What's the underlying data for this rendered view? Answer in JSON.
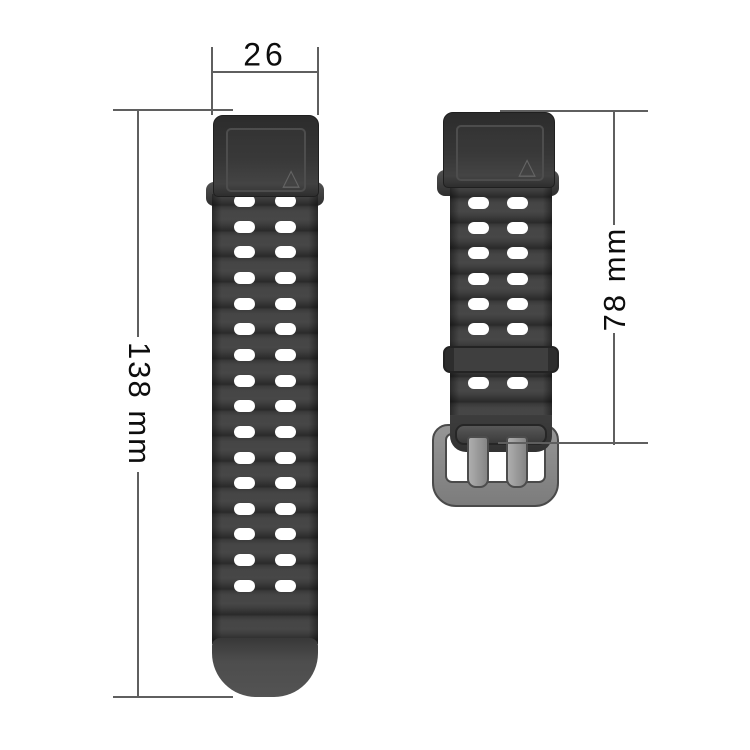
{
  "diagram": {
    "type": "product-dimension-diagram",
    "subject": "silicone watch band set (long strap and short buckle strap)",
    "background": "#ffffff",
    "annotations": {
      "width": {
        "label": "26",
        "unit": "mm (implied)",
        "applies_to": "strap lug width"
      },
      "long_strap_length": {
        "label": "138 mm",
        "orientation": "rotated 90deg clockwise, reads top-to-bottom"
      },
      "short_strap_length": {
        "label": "78 mm",
        "orientation": "rotated 90deg counter-clockwise, reads bottom-to-top"
      }
    },
    "long_strap": {
      "hole_rows": 16,
      "holes_per_row": 2,
      "features": [
        "lug attachment block with triangle mark",
        "ribbed texture",
        "rounded lighter tip"
      ],
      "body_color": "#3a3a3a",
      "tip_color": "#4f4f4f"
    },
    "short_strap": {
      "hole_rows_above_keeper": 6,
      "hole_rows_below_keeper": 1,
      "holes_per_row": 2,
      "features": [
        "lug attachment block with triangle mark",
        "ribbed texture",
        "keeper loop",
        "metal buckle with two prongs"
      ],
      "body_color": "#3a3a3a",
      "keeper_color": "#3f3f3f",
      "buckle_color": "#8a8a8a"
    },
    "icons": {
      "triangle_glyph": "△"
    },
    "colors": {
      "dimension_line": "#5f5f5f",
      "dimension_text": "#0d0d0d",
      "hole": "#ffffff"
    }
  }
}
